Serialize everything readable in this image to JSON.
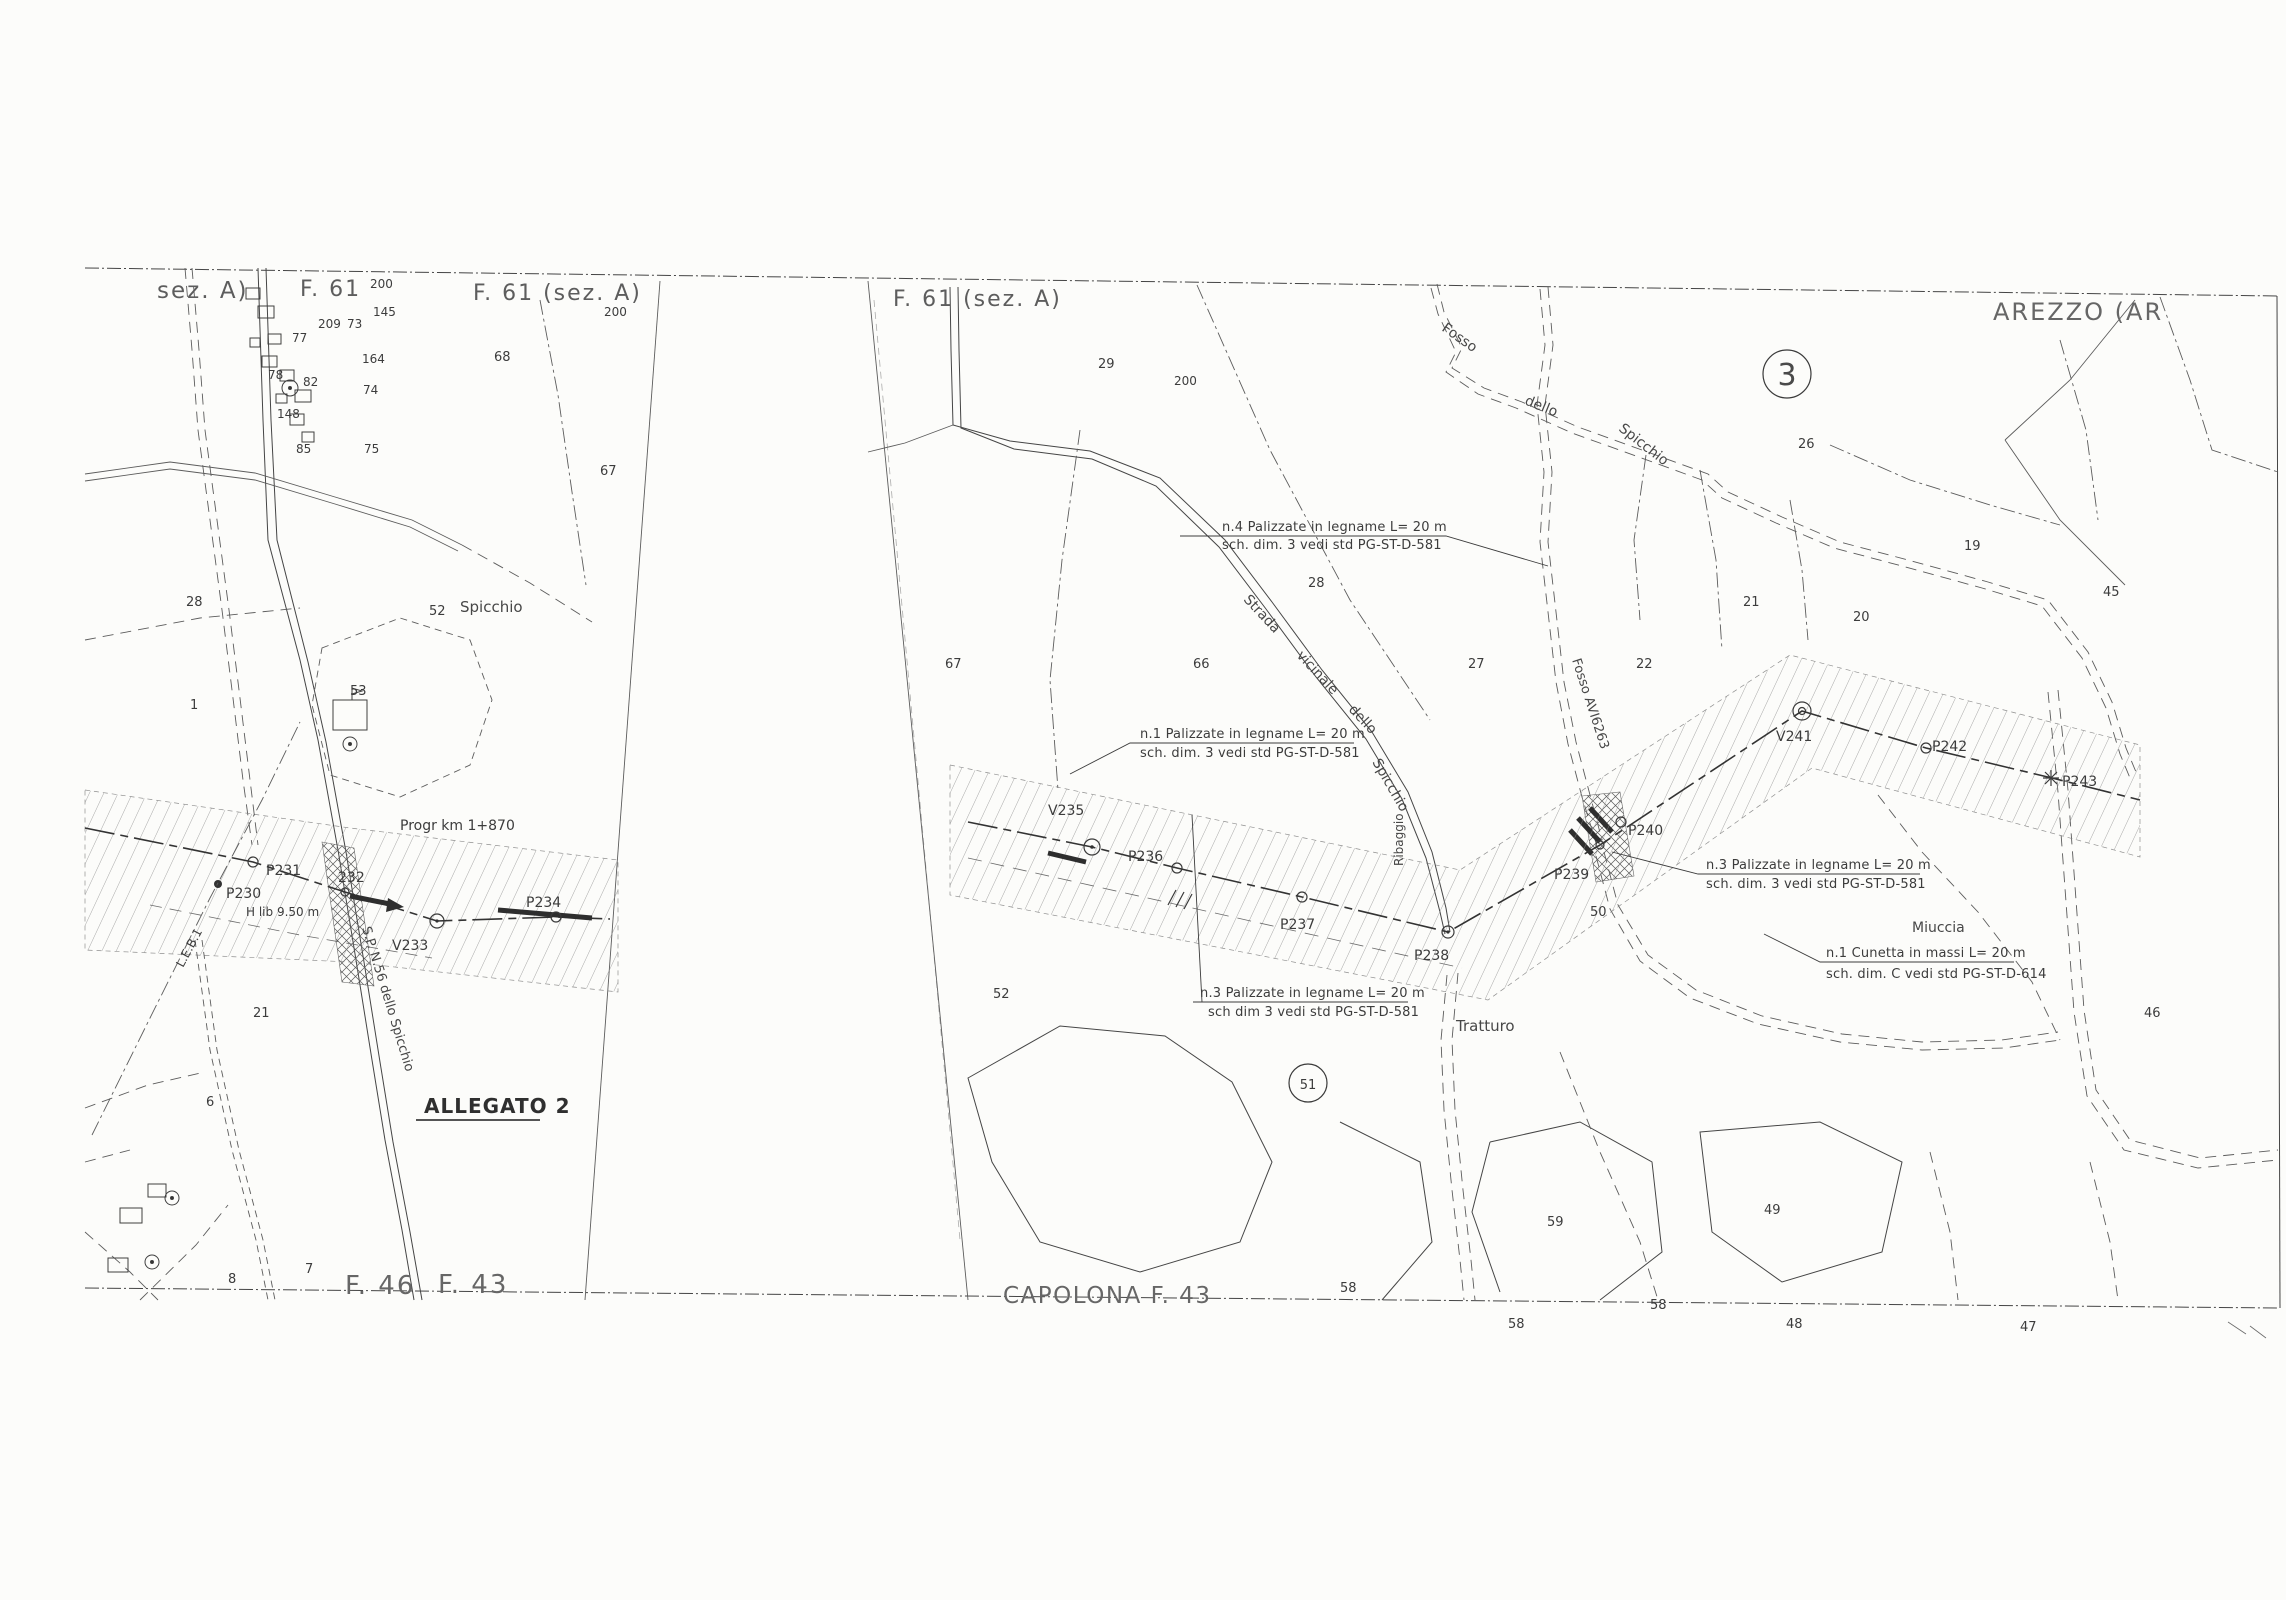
{
  "meta": {
    "kind": "scanned cadastral pipeline route map",
    "ink_color": "#3e3e3e",
    "paper_color": "#fcfcfa"
  },
  "sheet_titles": {
    "top_left_partial": "sez. A)",
    "top_left_f61": "F. 61",
    "mid_f61": "F. 61 (sez. A)",
    "center_f61": "F. 61 (sez. A)",
    "arezzo": "AREZZO (AR",
    "capolona": "CAPOLONA F. 43",
    "bottom_f46": "F. 46",
    "bottom_f43": "F. 43",
    "map_index_circle": "3",
    "attachment_label": "ALLEGATO 2"
  },
  "route_notes": {
    "progressive_km": "Progr km 1+870",
    "clearance": "H lib 9.50 m",
    "leb_line": "L.E.B.1"
  },
  "annotations": [
    {
      "line1": "n.4 Palizzate in legname L= 20 m",
      "line2": "sch. dim. 3 vedi std PG-ST-D-581"
    },
    {
      "line1": "n.1 Palizzate in legname L= 20 m",
      "line2": "sch. dim. 3 vedi std PG-ST-D-581"
    },
    {
      "line1": "n.3 Palizzate in legname L= 20 m",
      "line2": "sch dim 3 vedi std PG-ST-D-581"
    },
    {
      "line1": "n.3 Palizzate in legname L= 20 m",
      "line2": "sch. dim. 3 vedi std PG-ST-D-581"
    },
    {
      "line1": "n.1 Cunetta in massi L= 20 m",
      "line2": "sch. dim. C vedi std PG-ST-D-614"
    }
  ],
  "points": [
    "P230",
    "P231",
    "232",
    "V233",
    "P234",
    "V235",
    "P236",
    "P237",
    "P238",
    "P239",
    "P240",
    "V241",
    "P242",
    "P243"
  ],
  "toponyms": {
    "spicchio_left": "Spicchio",
    "sp_road": "S.P. N.56 dello Spicchio",
    "fosso1_a": "Fosso",
    "fosso1_b": "dello",
    "fosso1_c": "Spicchio",
    "strada_a": "Strada",
    "strada_b": "vicinale",
    "strada_c": "dello",
    "strada_d": "Spicchio",
    "fosso2": "Fosso AVI6263",
    "ribaggio": "Ribaggio",
    "tratturo": "Tratturo",
    "miuccia": "Miuccia"
  },
  "parcels": [
    "200",
    "145",
    "209",
    "73",
    "77",
    "164",
    "78",
    "82",
    "74",
    "148",
    "85",
    "75",
    "200",
    "68",
    "67",
    "28",
    "52",
    "53",
    "1",
    "21",
    "6",
    "7",
    "8",
    "200",
    "29",
    "26",
    "19",
    "28",
    "45",
    "21",
    "20",
    "67",
    "66",
    "27",
    "22",
    "50",
    "52",
    "46",
    "51",
    "59",
    "49",
    "58",
    "58",
    "58",
    "48",
    "47"
  ]
}
